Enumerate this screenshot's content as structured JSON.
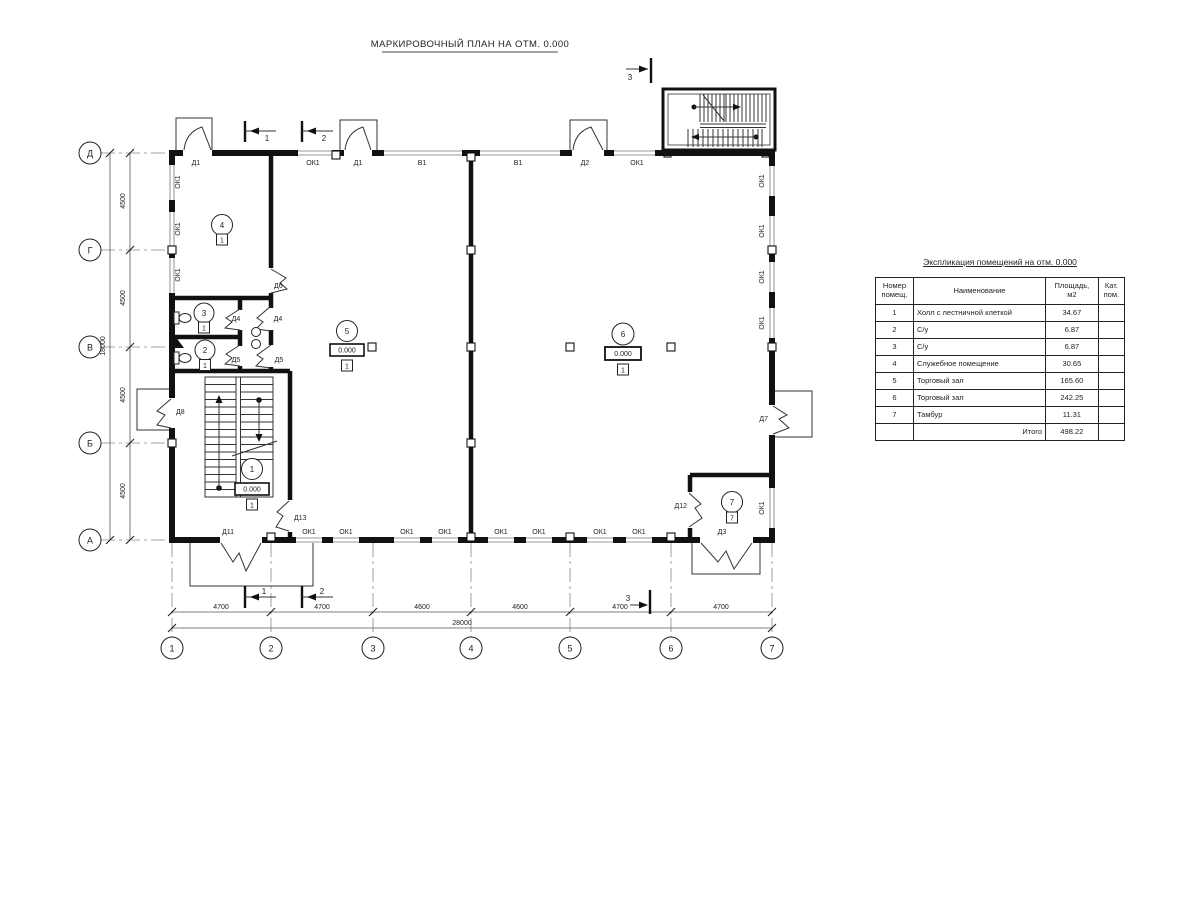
{
  "plan": {
    "title": "МАРКИРОВОЧНЫЙ ПЛАН НА ОТМ. 0.000",
    "lbl": {
      "ok1": "ОК1",
      "v1": "В1",
      "d1": "Д1",
      "d2": "Д2",
      "d3": "Д3",
      "d4": "Д4",
      "d5": "Д5",
      "d6": "Д6",
      "d7": "Д7",
      "d8": "Д8",
      "d11": "Д11",
      "d12": "Д12",
      "d13": "Д13",
      "elev": "0.000",
      "floor": "1",
      "floor7": "7"
    },
    "rooms": {
      "r1": "1",
      "r2": "2",
      "r3": "3",
      "r4": "4",
      "r5": "5",
      "r6": "6",
      "r7": "7"
    },
    "grid_cols": [
      "1",
      "2",
      "3",
      "4",
      "5",
      "6",
      "7"
    ],
    "grid_rows": [
      "Д",
      "Г",
      "В",
      "Б",
      "А"
    ],
    "sec": {
      "s1": "1",
      "s2": "2",
      "s3": "3"
    },
    "dims": {
      "h": [
        "4700",
        "4700",
        "4600",
        "4600",
        "4700",
        "4700"
      ],
      "htotal": "28000",
      "v": "4500",
      "vtotal": "18000"
    }
  },
  "table": {
    "title": "Экспликация помещений на отм. 0.000",
    "headers": {
      "num": "Номер помещ.",
      "name": "Наименование",
      "area": "Площадь,  м2",
      "cat": "Кат. пом."
    },
    "rows": [
      {
        "num": "1",
        "name": "Холл с лестничной клеткой",
        "area": "34.67",
        "cat": ""
      },
      {
        "num": "2",
        "name": "С/у",
        "area": "6.87",
        "cat": ""
      },
      {
        "num": "3",
        "name": "С/у",
        "area": "6.87",
        "cat": ""
      },
      {
        "num": "4",
        "name": "Служебное помещение",
        "area": "30.65",
        "cat": ""
      },
      {
        "num": "5",
        "name": "Торговый зал",
        "area": "165.60",
        "cat": ""
      },
      {
        "num": "6",
        "name": "Торговый зал",
        "area": "242.25",
        "cat": ""
      },
      {
        "num": "7",
        "name": "Тамбур",
        "area": "11.31",
        "cat": ""
      }
    ],
    "total_label": "Итого",
    "total_value": "498.22"
  }
}
